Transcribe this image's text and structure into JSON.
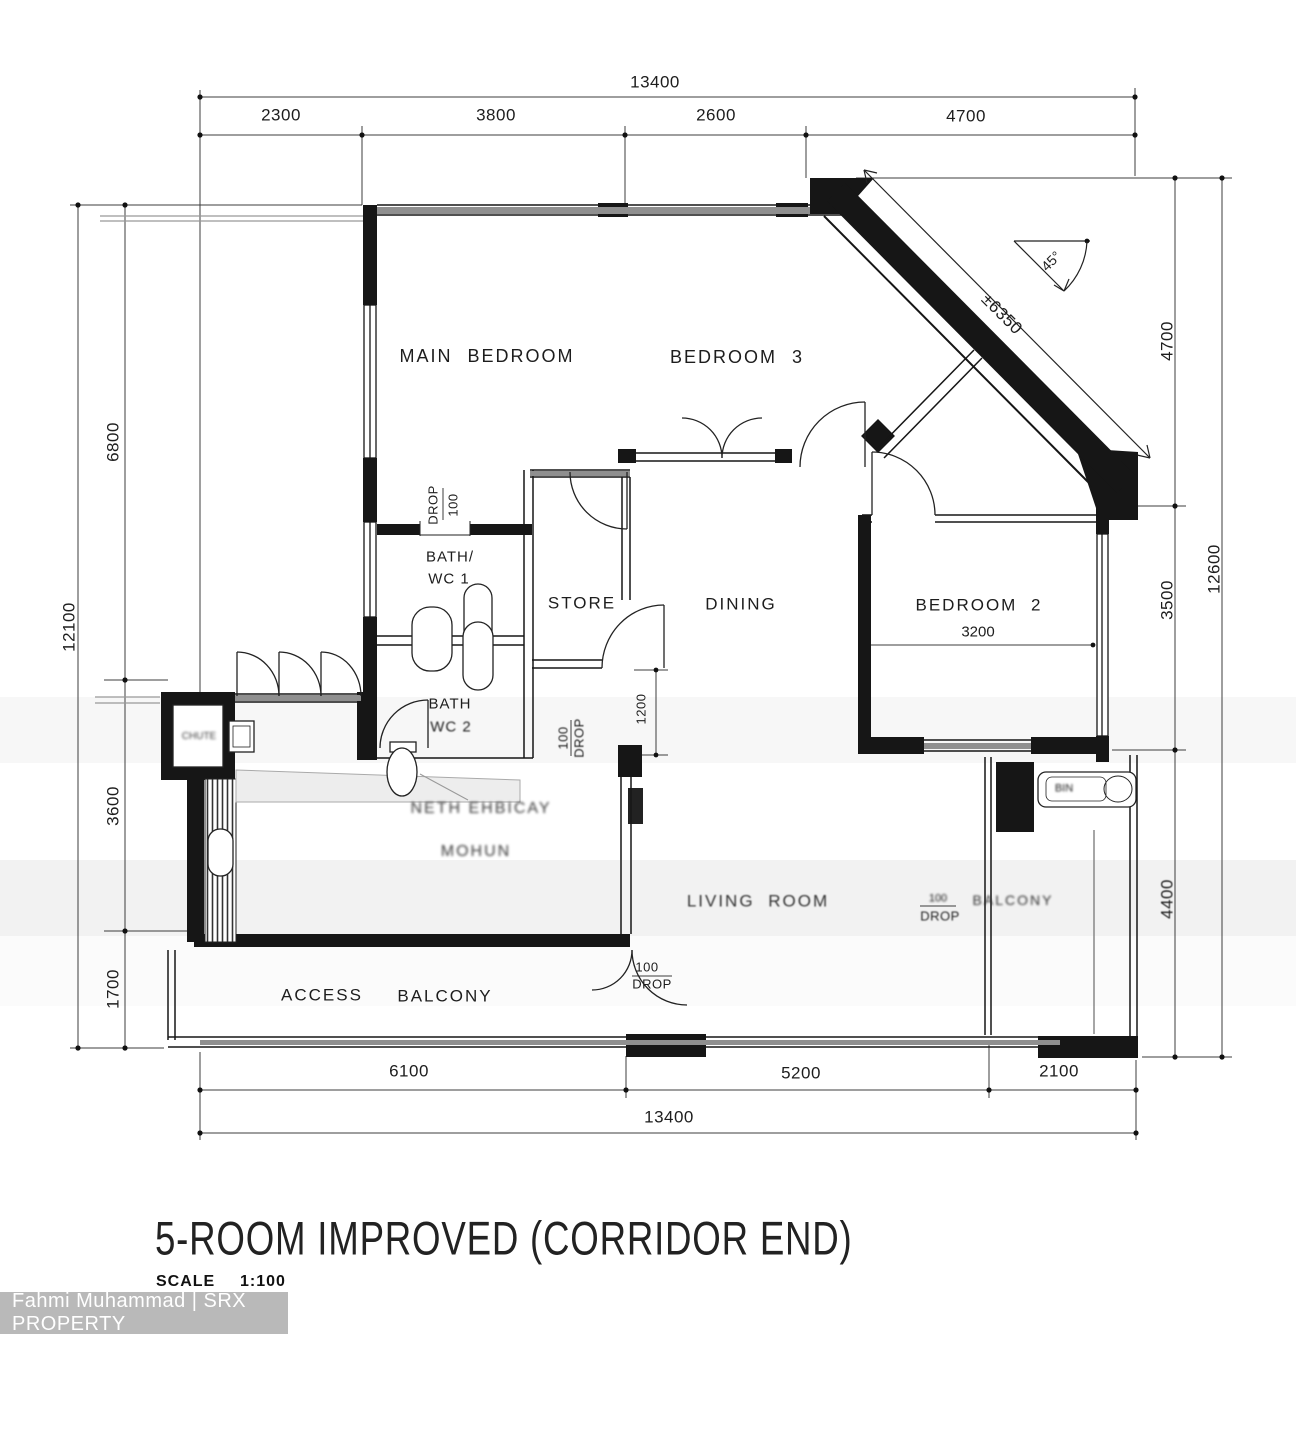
{
  "header": {
    "title": "5-ROOM IMPROVED (CORRIDOR END)",
    "scale_label": "SCALE",
    "scale_value": "1:100"
  },
  "watermark": {
    "text": "Fahmi Muhammad | SRX PROPERTY"
  },
  "rooms": {
    "main_bedroom": "MAIN BEDROOM",
    "bedroom_3": "BEDROOM 3",
    "bedroom_2": "BEDROOM 2",
    "bedroom_2_width": "3200",
    "dining": "DINING",
    "store": "STORE",
    "bath_wc_1": [
      "BATH/",
      "WC 1"
    ],
    "bath_wc_2": [
      "BATH",
      "WC 2"
    ],
    "living_room": "LIVING ROOM",
    "access_balcony": [
      "ACCESS",
      "BALCONY"
    ],
    "balcony": "BALCONY",
    "kitchen_garbled": [
      "NETH EHBICAY",
      "MOHUN"
    ],
    "chute_garbled": "CHUTE",
    "sink_label": "BIN"
  },
  "annotations": {
    "drop_bath": [
      "DROP",
      "100"
    ],
    "drop_store": [
      "100",
      "DROP"
    ],
    "drop_entry": [
      "100",
      "DROP"
    ],
    "drop_balcony": [
      "100",
      "DROP"
    ],
    "angle_45": "45°",
    "diagonal_length": "±6350",
    "hall_dim": "1200"
  },
  "dimensions": {
    "top": {
      "total": "13400",
      "segments": [
        "2300",
        "3800",
        "2600",
        "4700"
      ]
    },
    "bottom": {
      "total": "13400",
      "segments": [
        "6100",
        "5200",
        "2100"
      ]
    },
    "left": {
      "total": "12100",
      "segments": [
        "6800",
        "3600",
        "1700"
      ]
    },
    "right": {
      "total": "12600",
      "segments": [
        "4700",
        "3500",
        "4400"
      ]
    }
  },
  "colors": {
    "line": "#161616",
    "window_band": "#8f8f8f",
    "watermark_bg": "#b9b9b9",
    "watermark_text": "#ffffff"
  }
}
